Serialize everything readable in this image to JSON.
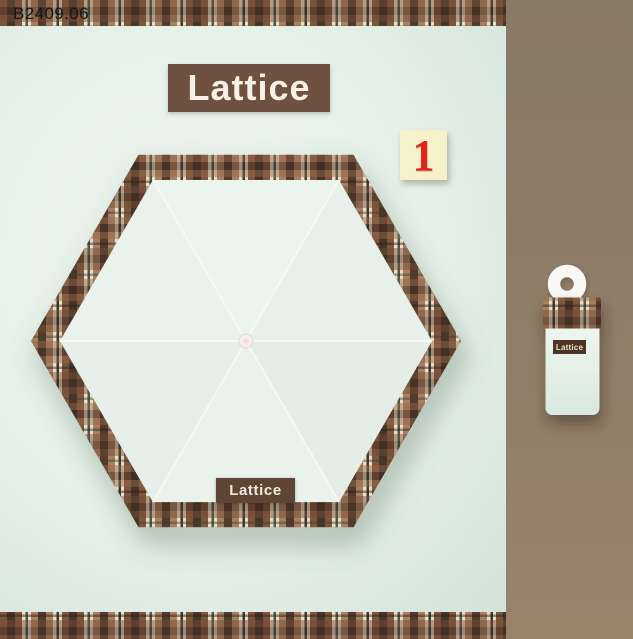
{
  "header": {
    "product_code": "B2409.06"
  },
  "brand": {
    "title_label": "Lattice",
    "canopy_tag_label": "Lattice",
    "folded_tag_label": "Lattice"
  },
  "annotation": {
    "option_number": "1"
  },
  "product": {
    "description": "hexagonal plaid-trim umbrella top view with folded umbrella on side panel",
    "canopy_panel_count": 6
  },
  "colors": {
    "background_mint": "#e4f0e8",
    "canopy_mint": "#e9f2ec",
    "side_panel_brown": "#8e7d69",
    "title_tag_brown": "#6e5140",
    "canopy_tag_brown": "#5e4534",
    "folded_tag_brown": "#4c3322",
    "plaid_cream": "#eddcc3",
    "plaid_brown_a": "#7d563e",
    "plaid_brown_b": "#a87f63",
    "plaid_dark_brown": "#4a3428",
    "plaid_pine_stripe": "#4b5a4a",
    "note_yellow": "#f5f2cb",
    "note_number_red": "#e3231a",
    "hub_white": "#f6eee8",
    "ring_handle_white": "#f9f8f4"
  }
}
